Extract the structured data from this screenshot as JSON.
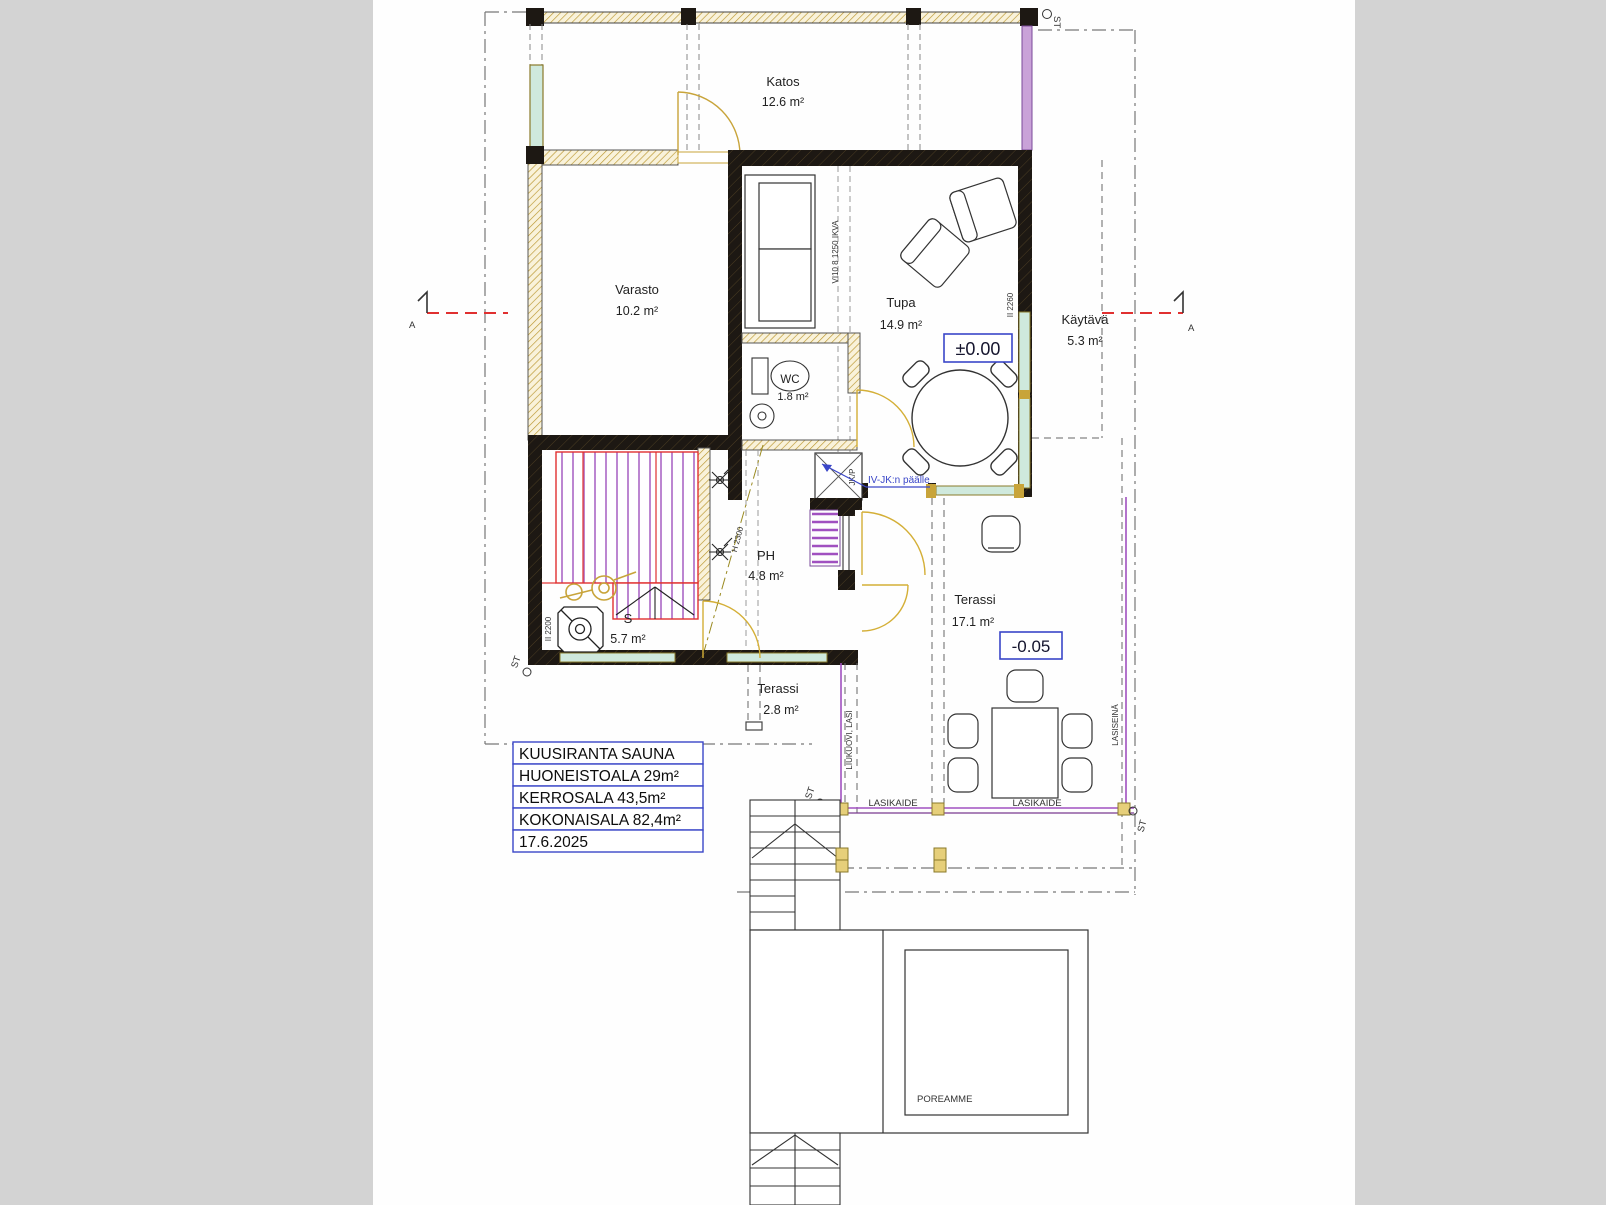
{
  "title_block": {
    "rows": [
      "KUUSIRANTA SAUNA",
      "HUONEISTOALA 29m²",
      "KERROSALA 43,5m²",
      "KOKONAISALA 82,4m²",
      "17.6.2025"
    ]
  },
  "rooms": {
    "katos": {
      "name": "Katos",
      "area": "12.6 m²"
    },
    "varasto": {
      "name": "Varasto",
      "area": "10.2 m²"
    },
    "tupa": {
      "name": "Tupa",
      "area": "14.9 m²"
    },
    "kaytava": {
      "name": "Käytävä",
      "area": "5.3 m²"
    },
    "wc": {
      "name": "WC",
      "area": "1.8 m²"
    },
    "ph": {
      "name": "PH",
      "area": "4.8 m²"
    },
    "sauna": {
      "name": "S",
      "area": "5.7 m²"
    },
    "terassi_iso": {
      "name": "Terassi",
      "area": "17.1 m²"
    },
    "terassi_pieni": {
      "name": "Terassi",
      "area": "2.8 m²"
    }
  },
  "levels": {
    "main_floor": "±0.00",
    "terrace": "-0.05"
  },
  "annotations": {
    "iv_jk": "IV-JK:n päälle",
    "jk_p": "JK/P",
    "poreamme": "POREAMME",
    "lasikaide": "LASIKAIDE",
    "lasiseina": "LASISEINÄ",
    "liukuovi": "LIUKUOVI, LASI",
    "window_mark": "VI10 8 1250 IKVA",
    "h_2300": "H 2300",
    "h_2260": "II 2260",
    "h_2200": "II 2200",
    "st": "ST",
    "section_letter": "A"
  },
  "colors": {
    "accent_blue": "#3a46c8",
    "section_red": "#e03030",
    "wall_black": "#1d1813",
    "wood_gold": "#c8a43a",
    "glass_teal": "#cfe9dd",
    "glass_purple": "#a050c0",
    "side_panel": "#d3d3d3"
  }
}
